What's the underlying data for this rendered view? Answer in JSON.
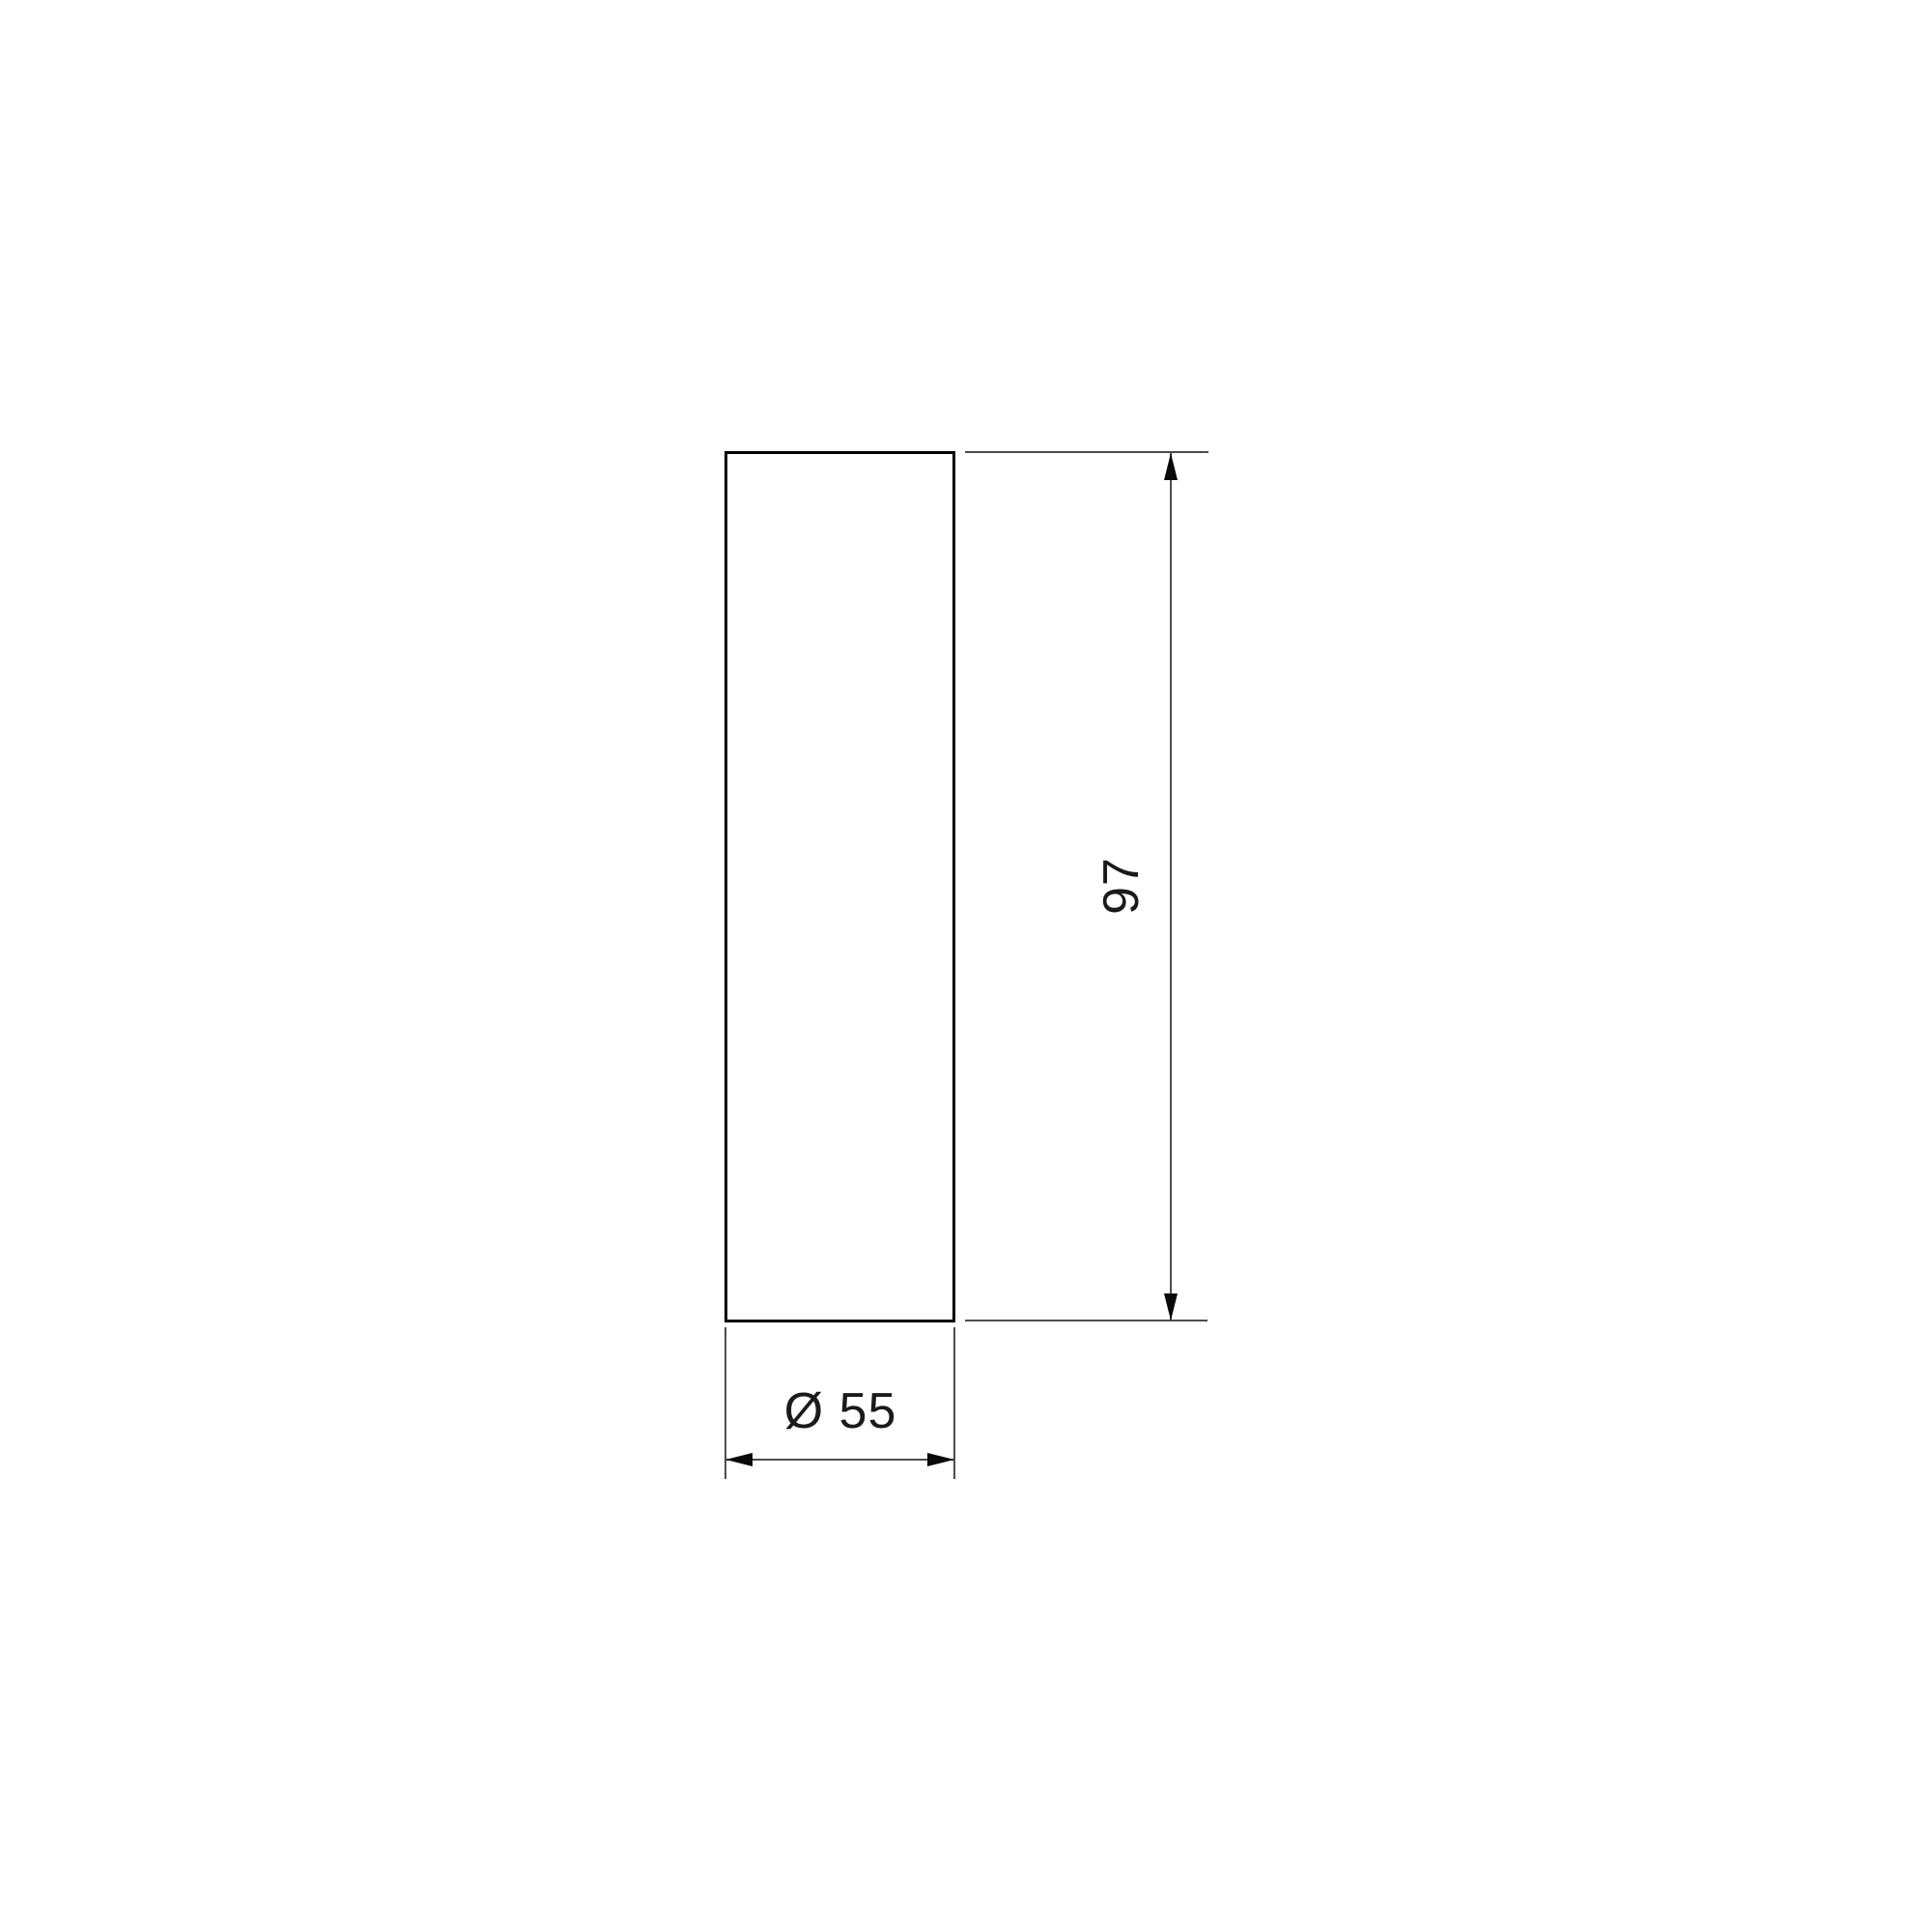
{
  "drawing": {
    "labels": {
      "height_dim": "97",
      "diameter_dim": "Ø 55"
    },
    "colors": {
      "background": "#ffffff",
      "outline": "#000000",
      "dimension_line": "#4d4d4d",
      "arrow": "#0a0a0a",
      "text": "#1a1a1a"
    }
  }
}
